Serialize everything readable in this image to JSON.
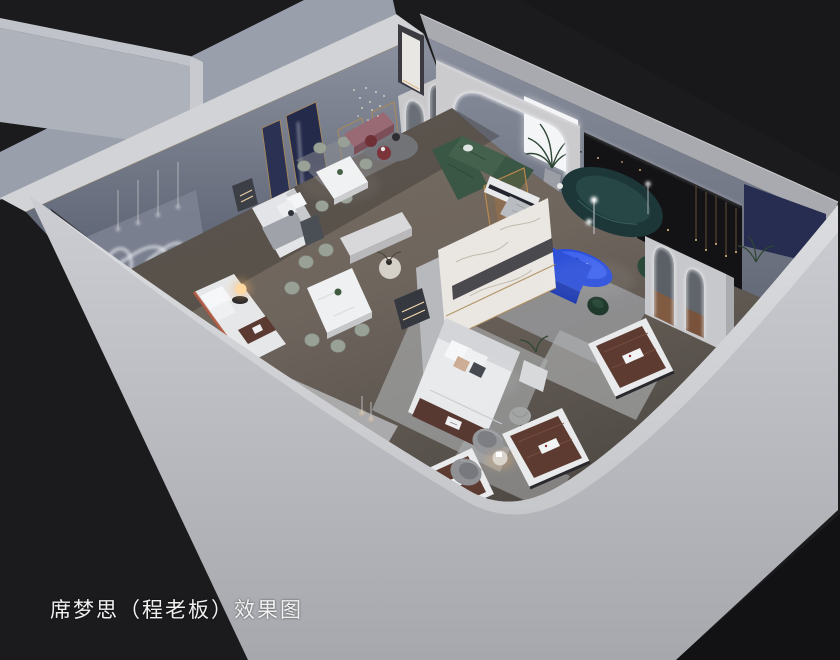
{
  "caption": {
    "text": "席梦思（程老板）效果图"
  },
  "scene": {
    "kind": "axonometric-cutaway-interior-render",
    "subject": "mattress showroom with bedroom, dining and living displays",
    "palette": {
      "backdrop": "#1b1b1d",
      "outer_wall": "#c9cacd",
      "wall_top": "#d8d9db",
      "interior_wall": "#868b99",
      "floor_wood": "#6f665f",
      "marble_partition": "#eae7e2",
      "navy_panel": "#272d50",
      "cobalt_blue": "#2c50dc",
      "dark_teal_sofa": "#1d3738",
      "forest_green_sofa": "#3d5a47",
      "mattress_brown": "#5e3b31",
      "warm_lamp_glow": "#ffd9a2",
      "led_white": "#f6f7fa",
      "mauve_bench": "#9a6a74",
      "terracotta_accent": "#b0573f"
    }
  }
}
